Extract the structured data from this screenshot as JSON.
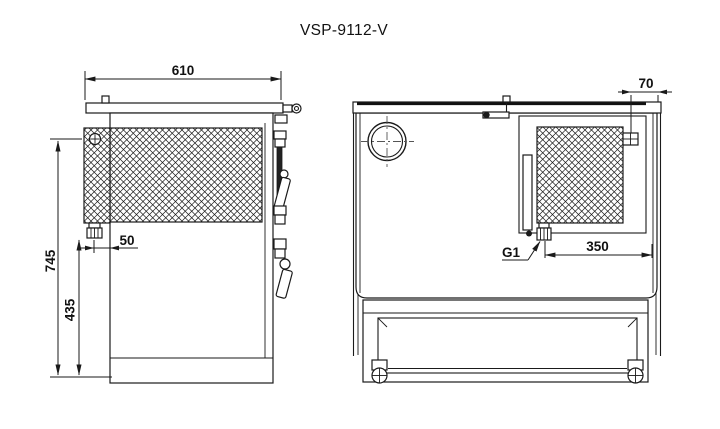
{
  "title": "VSP-9112-V",
  "colors": {
    "line": "#1a1a1a",
    "background": "#ffffff"
  },
  "side_view": {
    "width_mm": "610",
    "height_total_mm": "745",
    "height_lower_mm": "435",
    "fitting_offset_mm": "50"
  },
  "front_view": {
    "edge_offset_mm": "70",
    "fitting_span_mm": "350",
    "fitting_thread_label": "G1"
  }
}
